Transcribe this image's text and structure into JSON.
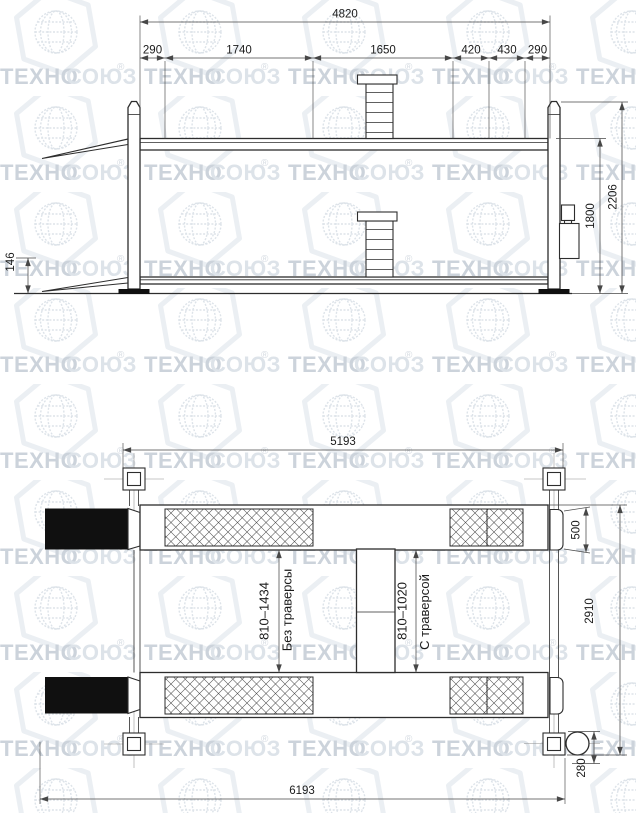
{
  "watermark": {
    "brand_part1": "ТЕХНО",
    "brand_part2": "СОЮЗ",
    "registered_mark": "®"
  },
  "side_view": {
    "dim_total_length": "4820",
    "dim_segments": [
      "290",
      "1740",
      "1650",
      "420",
      "430",
      "290"
    ],
    "dim_overall_height": "2206",
    "dim_platform_height": "1800",
    "dim_lowered_height": "146"
  },
  "plan_view": {
    "dim_span_between_posts": "5193",
    "dim_overall_length": "6193",
    "dim_runway_width": "500",
    "dim_overall_width": "2910",
    "dim_power_unit_offset": "280",
    "runway_gap_no_traverse": {
      "range": "810–1434",
      "label": "Без траверсы"
    },
    "runway_gap_traverse": {
      "range": "810–1020",
      "label": "С траверсой"
    }
  }
}
